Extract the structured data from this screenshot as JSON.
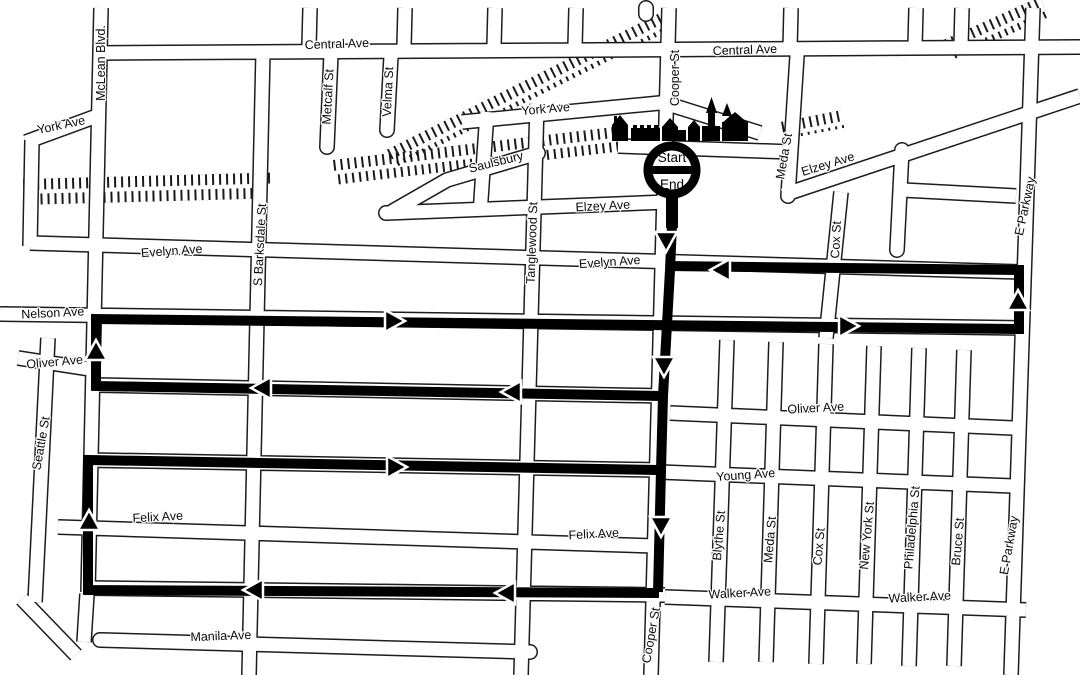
{
  "marker": {
    "start_label": "Start",
    "end_label": "End"
  },
  "colors": {
    "background": "#ffffff",
    "route": "#000000",
    "street_outline": "#1c1c1c",
    "label": "#0a0a0a"
  },
  "icons": {
    "landmark_row": "town-buildings-silhouette-icon",
    "railroad": "railroad-track-hatching",
    "start_end": "start-end-circle-marker"
  },
  "street_labels": [
    {
      "text": "McLean Blvd.",
      "x": 105,
      "y": 63,
      "rot": -90
    },
    {
      "text": "Central Ave",
      "x": 337,
      "y": 48,
      "rot": -2
    },
    {
      "text": "Metcalf St",
      "x": 332,
      "y": 97,
      "rot": -87
    },
    {
      "text": "Velma St",
      "x": 392,
      "y": 92,
      "rot": -87
    },
    {
      "text": "York Ave",
      "x": 62,
      "y": 129,
      "rot": -12
    },
    {
      "text": "York Ave",
      "x": 546,
      "y": 113,
      "rot": -5
    },
    {
      "text": "Central Ave",
      "x": 745,
      "y": 54,
      "rot": -2
    },
    {
      "text": "Cooper St",
      "x": 679,
      "y": 78,
      "rot": -90
    },
    {
      "text": "Meda St",
      "x": 788,
      "y": 157,
      "rot": -80
    },
    {
      "text": "Elzey Ave",
      "x": 829,
      "y": 168,
      "rot": -17
    },
    {
      "text": "E Parkway",
      "x": 1029,
      "y": 207,
      "rot": -78
    },
    {
      "text": "Saulsbury",
      "x": 497,
      "y": 166,
      "rot": -14
    },
    {
      "text": "Elzey Ave",
      "x": 603,
      "y": 210,
      "rot": -3
    },
    {
      "text": "Cox St",
      "x": 840,
      "y": 240,
      "rot": -87
    },
    {
      "text": "Evelyn Ave",
      "x": 172,
      "y": 255,
      "rot": -4
    },
    {
      "text": "Evelyn Ave",
      "x": 610,
      "y": 266,
      "rot": -4
    },
    {
      "text": "S Barksdale St",
      "x": 264,
      "y": 245,
      "rot": -87
    },
    {
      "text": "Tanglewood St",
      "x": 536,
      "y": 243,
      "rot": -88
    },
    {
      "text": "Nelson Ave",
      "x": 53,
      "y": 317,
      "rot": -3
    },
    {
      "text": "Oliver Ave",
      "x": 55,
      "y": 366,
      "rot": -5
    },
    {
      "text": "Oliver Ave",
      "x": 816,
      "y": 412,
      "rot": -3
    },
    {
      "text": "Seattle St",
      "x": 45,
      "y": 444,
      "rot": -80
    },
    {
      "text": "Young Ave",
      "x": 746,
      "y": 479,
      "rot": -4
    },
    {
      "text": "Felix Ave",
      "x": 158,
      "y": 521,
      "rot": -3
    },
    {
      "text": "Felix Ave",
      "x": 594,
      "y": 538,
      "rot": -3
    },
    {
      "text": "Blythe St",
      "x": 723,
      "y": 536,
      "rot": -85
    },
    {
      "text": "Meda St",
      "x": 774,
      "y": 540,
      "rot": -85
    },
    {
      "text": "Cox St",
      "x": 823,
      "y": 547,
      "rot": -85
    },
    {
      "text": "New York St",
      "x": 871,
      "y": 536,
      "rot": -85
    },
    {
      "text": "Philadelphia St",
      "x": 916,
      "y": 528,
      "rot": -85
    },
    {
      "text": "Bruce St",
      "x": 962,
      "y": 542,
      "rot": -85
    },
    {
      "text": "E Parkway",
      "x": 1013,
      "y": 546,
      "rot": -80
    },
    {
      "text": "Walker Ave",
      "x": 740,
      "y": 597,
      "rot": -3
    },
    {
      "text": "Walker Ave",
      "x": 920,
      "y": 601,
      "rot": -3
    },
    {
      "text": "Cooper St",
      "x": 655,
      "y": 636,
      "rot": -80
    },
    {
      "text": "Manila Ave",
      "x": 221,
      "y": 640,
      "rot": -2
    }
  ],
  "route": {
    "color": "#000000",
    "arrows": [
      {
        "x": 666,
        "y": 240,
        "dir": "down"
      },
      {
        "x": 664,
        "y": 365,
        "dir": "down"
      },
      {
        "x": 661,
        "y": 525,
        "dir": "down"
      },
      {
        "x": 722,
        "y": 270,
        "dir": "left"
      },
      {
        "x": 1018,
        "y": 302,
        "dir": "up"
      },
      {
        "x": 393,
        "y": 321,
        "dir": "right"
      },
      {
        "x": 847,
        "y": 326,
        "dir": "right"
      },
      {
        "x": 96,
        "y": 352,
        "dir": "up"
      },
      {
        "x": 513,
        "y": 392,
        "dir": "left"
      },
      {
        "x": 263,
        "y": 388,
        "dir": "left"
      },
      {
        "x": 395,
        "y": 467,
        "dir": "right"
      },
      {
        "x": 89,
        "y": 522,
        "dir": "up"
      },
      {
        "x": 507,
        "y": 593,
        "dir": "left"
      },
      {
        "x": 255,
        "y": 590,
        "dir": "left"
      },
      {
        "x": 672,
        "y": 213,
        "dir": "up",
        "size": "small"
      }
    ]
  }
}
